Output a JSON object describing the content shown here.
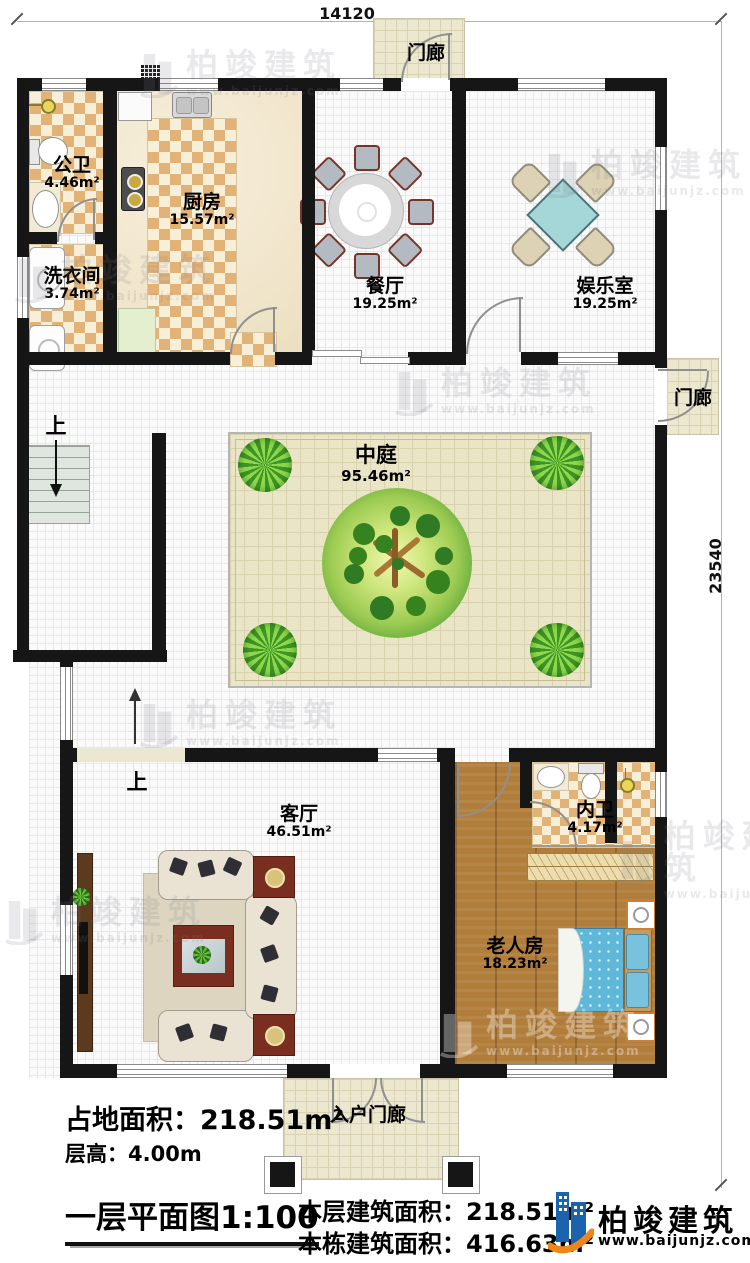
{
  "document": {
    "kind": "floor-plan"
  },
  "dimensions": {
    "width_mm": "14120",
    "height_mm": "23540"
  },
  "rooms": [
    {
      "name": "公卫",
      "area": "4.46m²"
    },
    {
      "name": "洗衣间",
      "area": "3.74m²"
    },
    {
      "name": "厨房",
      "area": "15.57m²"
    },
    {
      "name": "餐厅",
      "area": "19.25m²"
    },
    {
      "name": "娱乐室",
      "area": "19.25m²"
    },
    {
      "name": "中庭",
      "area": "95.46m²"
    },
    {
      "name": "客厅",
      "area": "46.51m²"
    },
    {
      "name": "内卫",
      "area": "4.17m²"
    },
    {
      "name": "老人房",
      "area": "18.23m²"
    }
  ],
  "porches": {
    "top": "门廊",
    "side": "门廊",
    "entry": "入户门廊"
  },
  "stairs": {
    "up_label": "上"
  },
  "footer": {
    "land_area_label": "占地面积：",
    "land_area_value": "218.51m²",
    "floor_height": "层高：4.00m",
    "plan_title": "一层平面图1:100",
    "floor_area_label": "本层建筑面积：",
    "floor_area_value": "218.51m²",
    "total_area_label": "本栋建筑面积：",
    "total_area_value": "416.63m²"
  },
  "brand": {
    "name": "柏竣建筑",
    "site": "www.baijunjz.com"
  },
  "watermark": {
    "name": "柏竣建筑",
    "site": "www.baijunjz.com"
  },
  "colors": {
    "wall": "#161616",
    "tile": "#e3b277",
    "wood": "#b17d3b",
    "courtyard": "#ebe5c8",
    "brand_blue": "#1c63ad",
    "brand_orange": "#f08519"
  }
}
